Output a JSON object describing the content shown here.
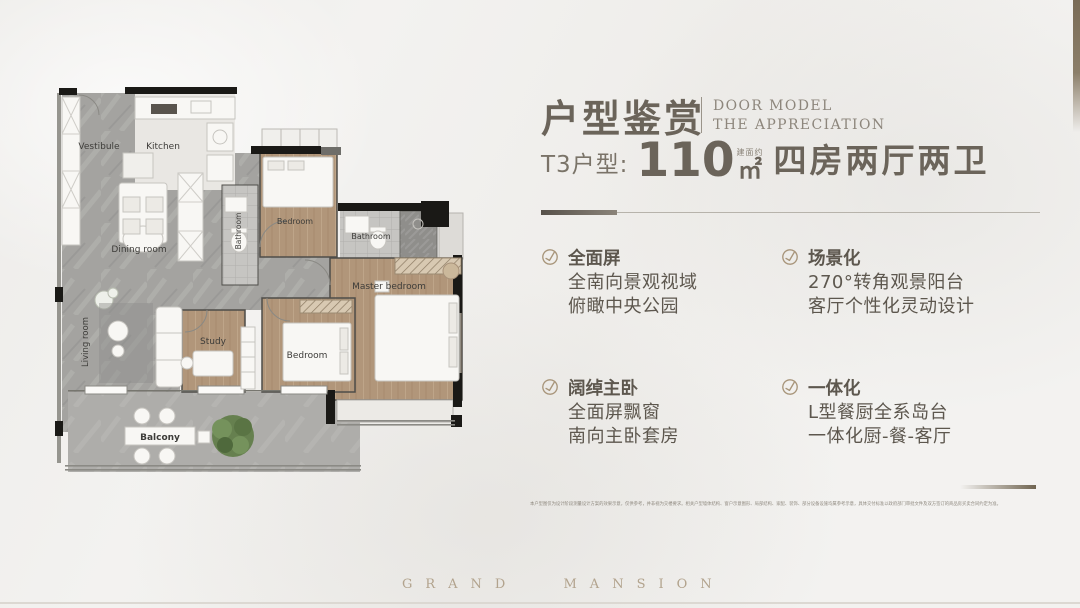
{
  "header": {
    "title_cn": "户型鉴赏",
    "en_line1": "DOOR MODEL",
    "en_line2": "THE APPRECIATION",
    "unit_label": "T3户型:",
    "area_value": "110",
    "area_note": "建面约",
    "area_unit": "㎡",
    "rooms_desc": "四房两厅两卫"
  },
  "features": [
    {
      "title": "全面屏",
      "line1": "全南向景观视域",
      "line2": "俯瞰中央公园"
    },
    {
      "title": "场景化",
      "line1": "270°转角观景阳台",
      "line2": "客厅个性化灵动设计"
    },
    {
      "title": "阔绰主卧",
      "line1": "全面屏飘窗",
      "line2": "南向主卧套房"
    },
    {
      "title": "一体化",
      "line1": "L型餐厨全系岛台",
      "line2": "一体化厨-餐-客厅"
    }
  ],
  "floorplan": {
    "vestibule": "Vestibule",
    "kitchen": "Kitchen",
    "dining": "Dining room",
    "bathroom_small": "Bathroom",
    "bedroom_top": "Bedroom",
    "bathroom_main": "Bathroom",
    "master": "Master bedroom",
    "living": "Living room",
    "study": "Study",
    "bedroom_mid": "Bedroom",
    "balcony": "Balcony"
  },
  "disclaimer": "本户型图仅为设计阶段测量设计方案的效果示意，仅供参考，并非视为交楼要求。相关户型墙体结构、窗户示意图形、局部结构、家配、装饰、部分设备设施均属参考示意，具体交付标准以政府部门审批文件及双方签订的商品房买卖合同约定为准。",
  "footer": {
    "brand": "GRAND MANSION"
  },
  "colors": {
    "accent": "#6b645a",
    "icon_tan": "#a8957a",
    "brand_tan": "#b2a38d"
  }
}
